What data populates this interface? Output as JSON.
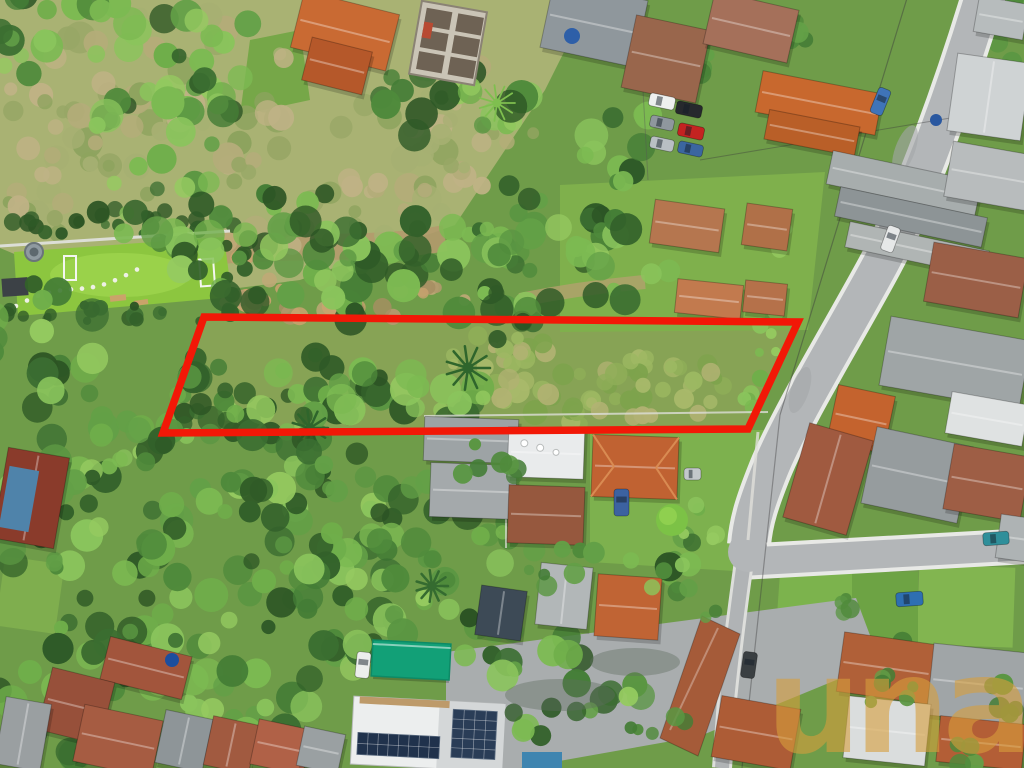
{
  "photo": {
    "kind": "aerial-drone-photo",
    "subject": "vacant land plot outlined in red among houses, forest and streets",
    "watermark": {
      "text": "una",
      "color": "#D79E3C"
    },
    "lot_highlight": {
      "color": "#F21807",
      "stroke_width": "7.5",
      "points": "204,317 798,322 748,429 163,433"
    },
    "colors": {
      "vegetation_dark": "#2c5424",
      "vegetation_bright": "#8cc63f",
      "road": "#b3b6b8",
      "roof_orange": "#c0642f",
      "roof_rust": "#9a5a40",
      "roof_gray": "#9aa0a4",
      "canopy_teal": "#12a077"
    },
    "features": [
      "soccer-field",
      "playground",
      "forest",
      "vacant-lot",
      "diagonal-street",
      "cross-street",
      "houses",
      "driveway",
      "solar-roof",
      "parked-cars"
    ]
  }
}
